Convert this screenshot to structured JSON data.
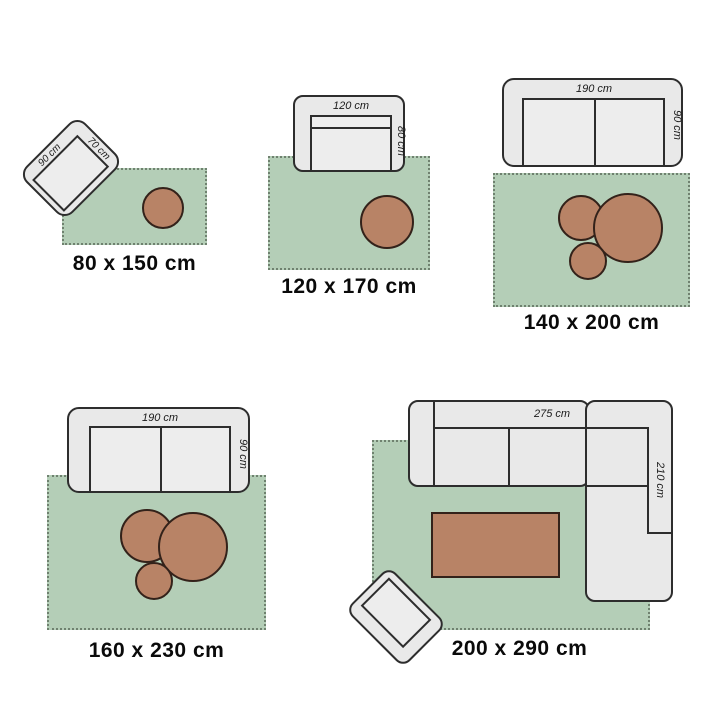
{
  "groups": [
    {
      "size_label": "80 x 150 cm",
      "furniture": {
        "type": "armchair",
        "side_label": "90 cm",
        "front_label": "70 cm"
      }
    },
    {
      "size_label": "120 x 170 cm",
      "furniture": {
        "type": "loveseat",
        "width_label": "120 cm",
        "depth_label": "80 cm"
      }
    },
    {
      "size_label": "140 x 200 cm",
      "furniture": {
        "type": "two-seat-sofa",
        "width_label": "190 cm",
        "depth_label": "90 cm"
      }
    },
    {
      "size_label": "160 x 230 cm",
      "furniture": {
        "type": "two-seat-sofa",
        "width_label": "190 cm",
        "depth_label": "90 cm"
      }
    },
    {
      "size_label": "200 x 290 cm",
      "furniture": {
        "type": "corner-sofa",
        "width_label": "275 cm",
        "depth_label": "210 cm"
      }
    }
  ],
  "colors": {
    "background": "#ffffff",
    "rug": "#b4ceb7",
    "rug_edge": "#6f816f",
    "furniture_fill": "#e9e9e9",
    "furniture_seat": "#ededed",
    "outline": "#2d2d2d",
    "table": "#b88366",
    "table_outline": "#33221a",
    "label": "#0a0a0a",
    "dim_text": "#1a1a1a"
  }
}
